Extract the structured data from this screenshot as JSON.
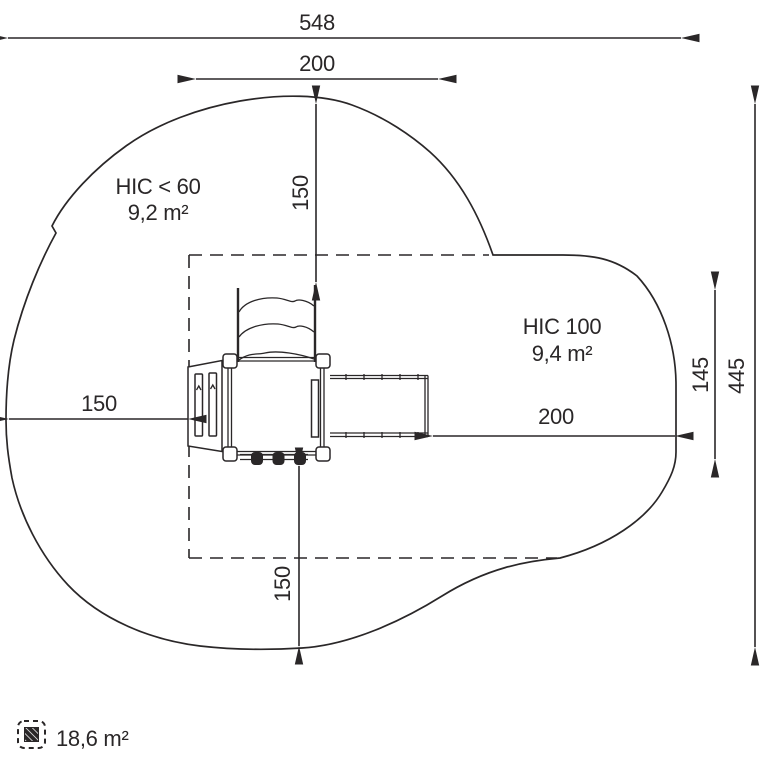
{
  "drawing": {
    "zones": {
      "left": {
        "name": "HIC < 60",
        "area": "9,2 m²"
      },
      "right": {
        "name": "HIC 100",
        "area": "9,4 m²"
      }
    },
    "dimensions": {
      "overall_width": "548",
      "upper_width": "200",
      "upper_clearance": "150",
      "left_clearance": "150",
      "lower_clearance": "150",
      "right_clearance": "200",
      "right_span": "145",
      "overall_depth": "445"
    },
    "legend": {
      "total_area": "18,6 m²"
    },
    "colors": {
      "line": "#2a2728",
      "background": "#ffffff"
    }
  }
}
